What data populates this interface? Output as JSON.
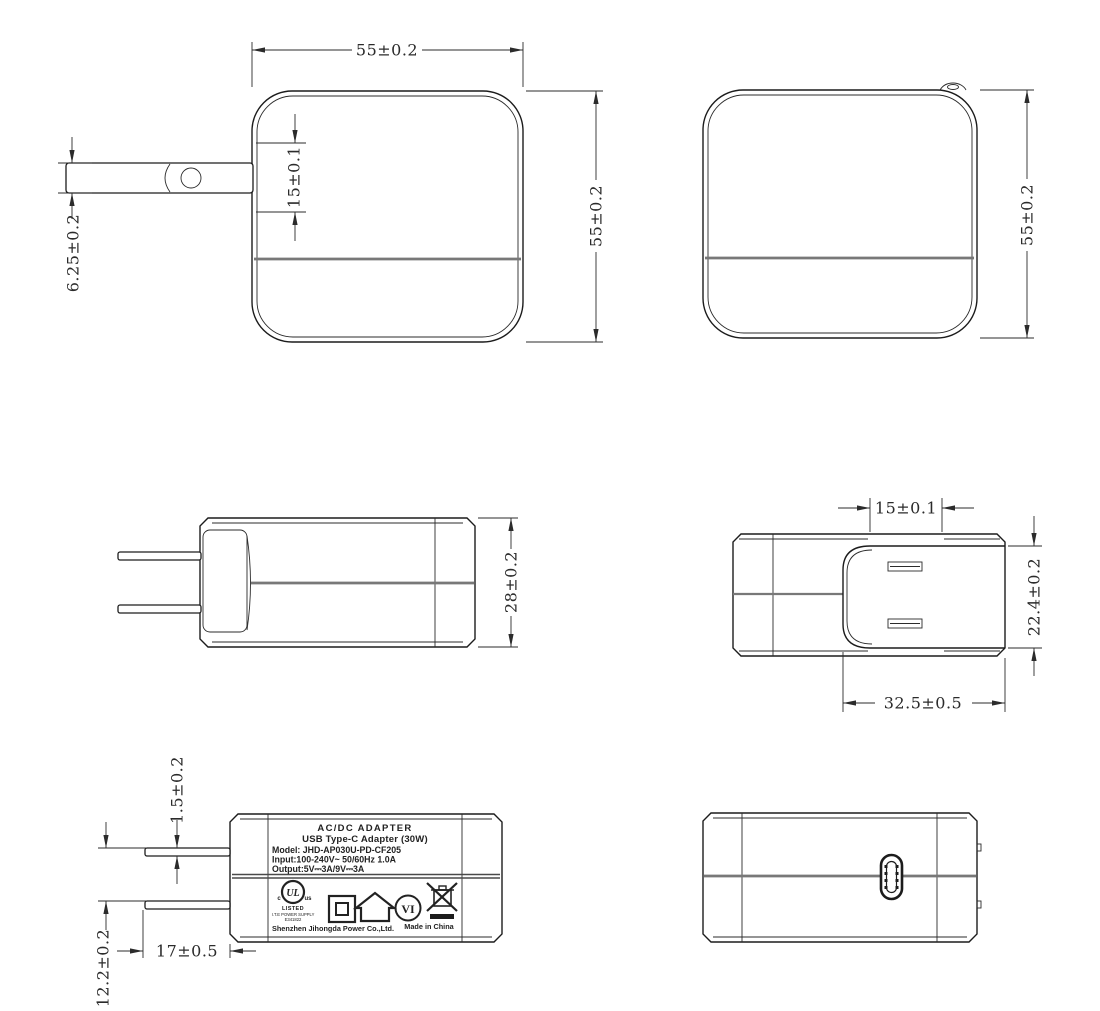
{
  "dims": {
    "front_width": "55±0.2",
    "front_height": "55±0.2",
    "plug_slot_width": "15±0.1",
    "pin_width": "6.25±0.2",
    "back_height": "55±0.2",
    "side_height": "28±0.2",
    "blade_gap": "15±0.1",
    "platform_height": "22.4±0.2",
    "platform_width": "32.5±0.5",
    "pin_thickness": "1.5±0.2",
    "pin_spacing": "12.2±0.2",
    "pin_length": "17±0.5"
  },
  "label": {
    "title": "AC/DC  ADAPTER",
    "subtitle": "USB Type-C Adapter   (30W)",
    "model": "Model: JHD-AP030U-PD-CF205",
    "input": "Input:100-240V~  50/60Hz  1.0A",
    "output": "Output:5V⎓3A/9V⎓3A",
    "ul_mark": "UL",
    "ul_c": "c",
    "ul_us": "us",
    "ul_listed": "LISTED",
    "ul_type": "I.T.E POWER SUPPLY",
    "ul_file": "E341822",
    "efficiency_level": "VI",
    "company": "Shenzhen Jihongda Power Co.,Ltd.",
    "made_in": "Made in China"
  }
}
